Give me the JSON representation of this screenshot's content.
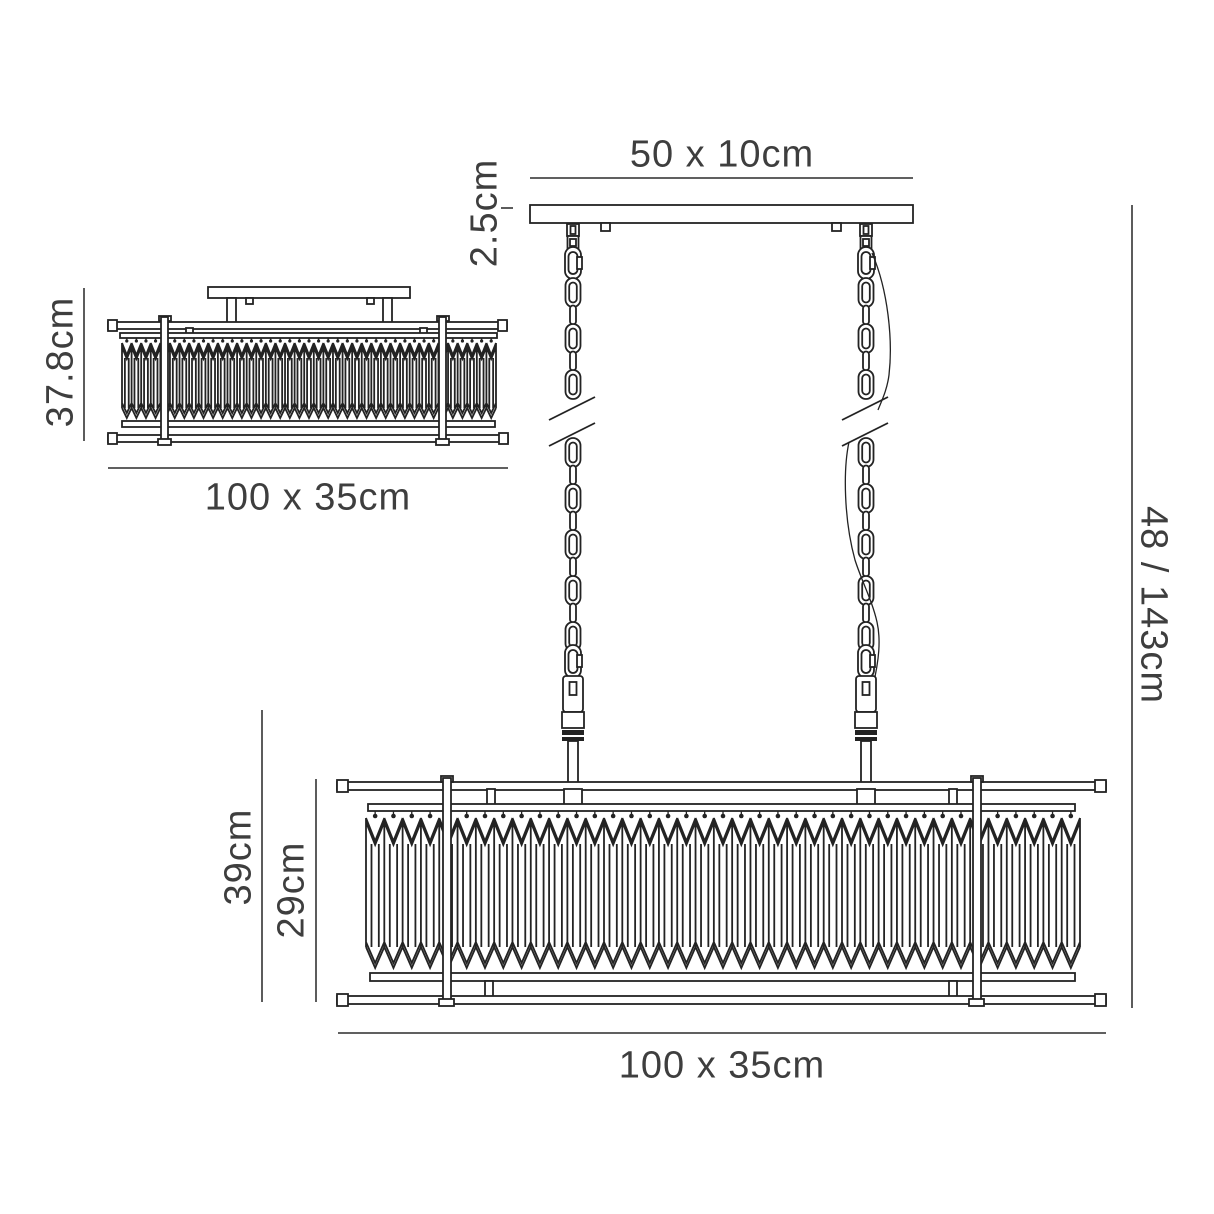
{
  "colors": {
    "line": "#232323",
    "dimension_line": "#4a4a4a",
    "text": "#3e3e3e",
    "background": "#ffffff"
  },
  "side_view": {
    "height_label": "37.8cm",
    "width_label": "100 x 35cm"
  },
  "pendant_view": {
    "canopy_label": "50 x 10cm",
    "canopy_height_label": "2.5cm",
    "overall_drop_label": "48 / 143cm",
    "body_height_label": "39cm",
    "crystal_band_height_label": "29cm",
    "width_label": "100 x 35cm"
  }
}
